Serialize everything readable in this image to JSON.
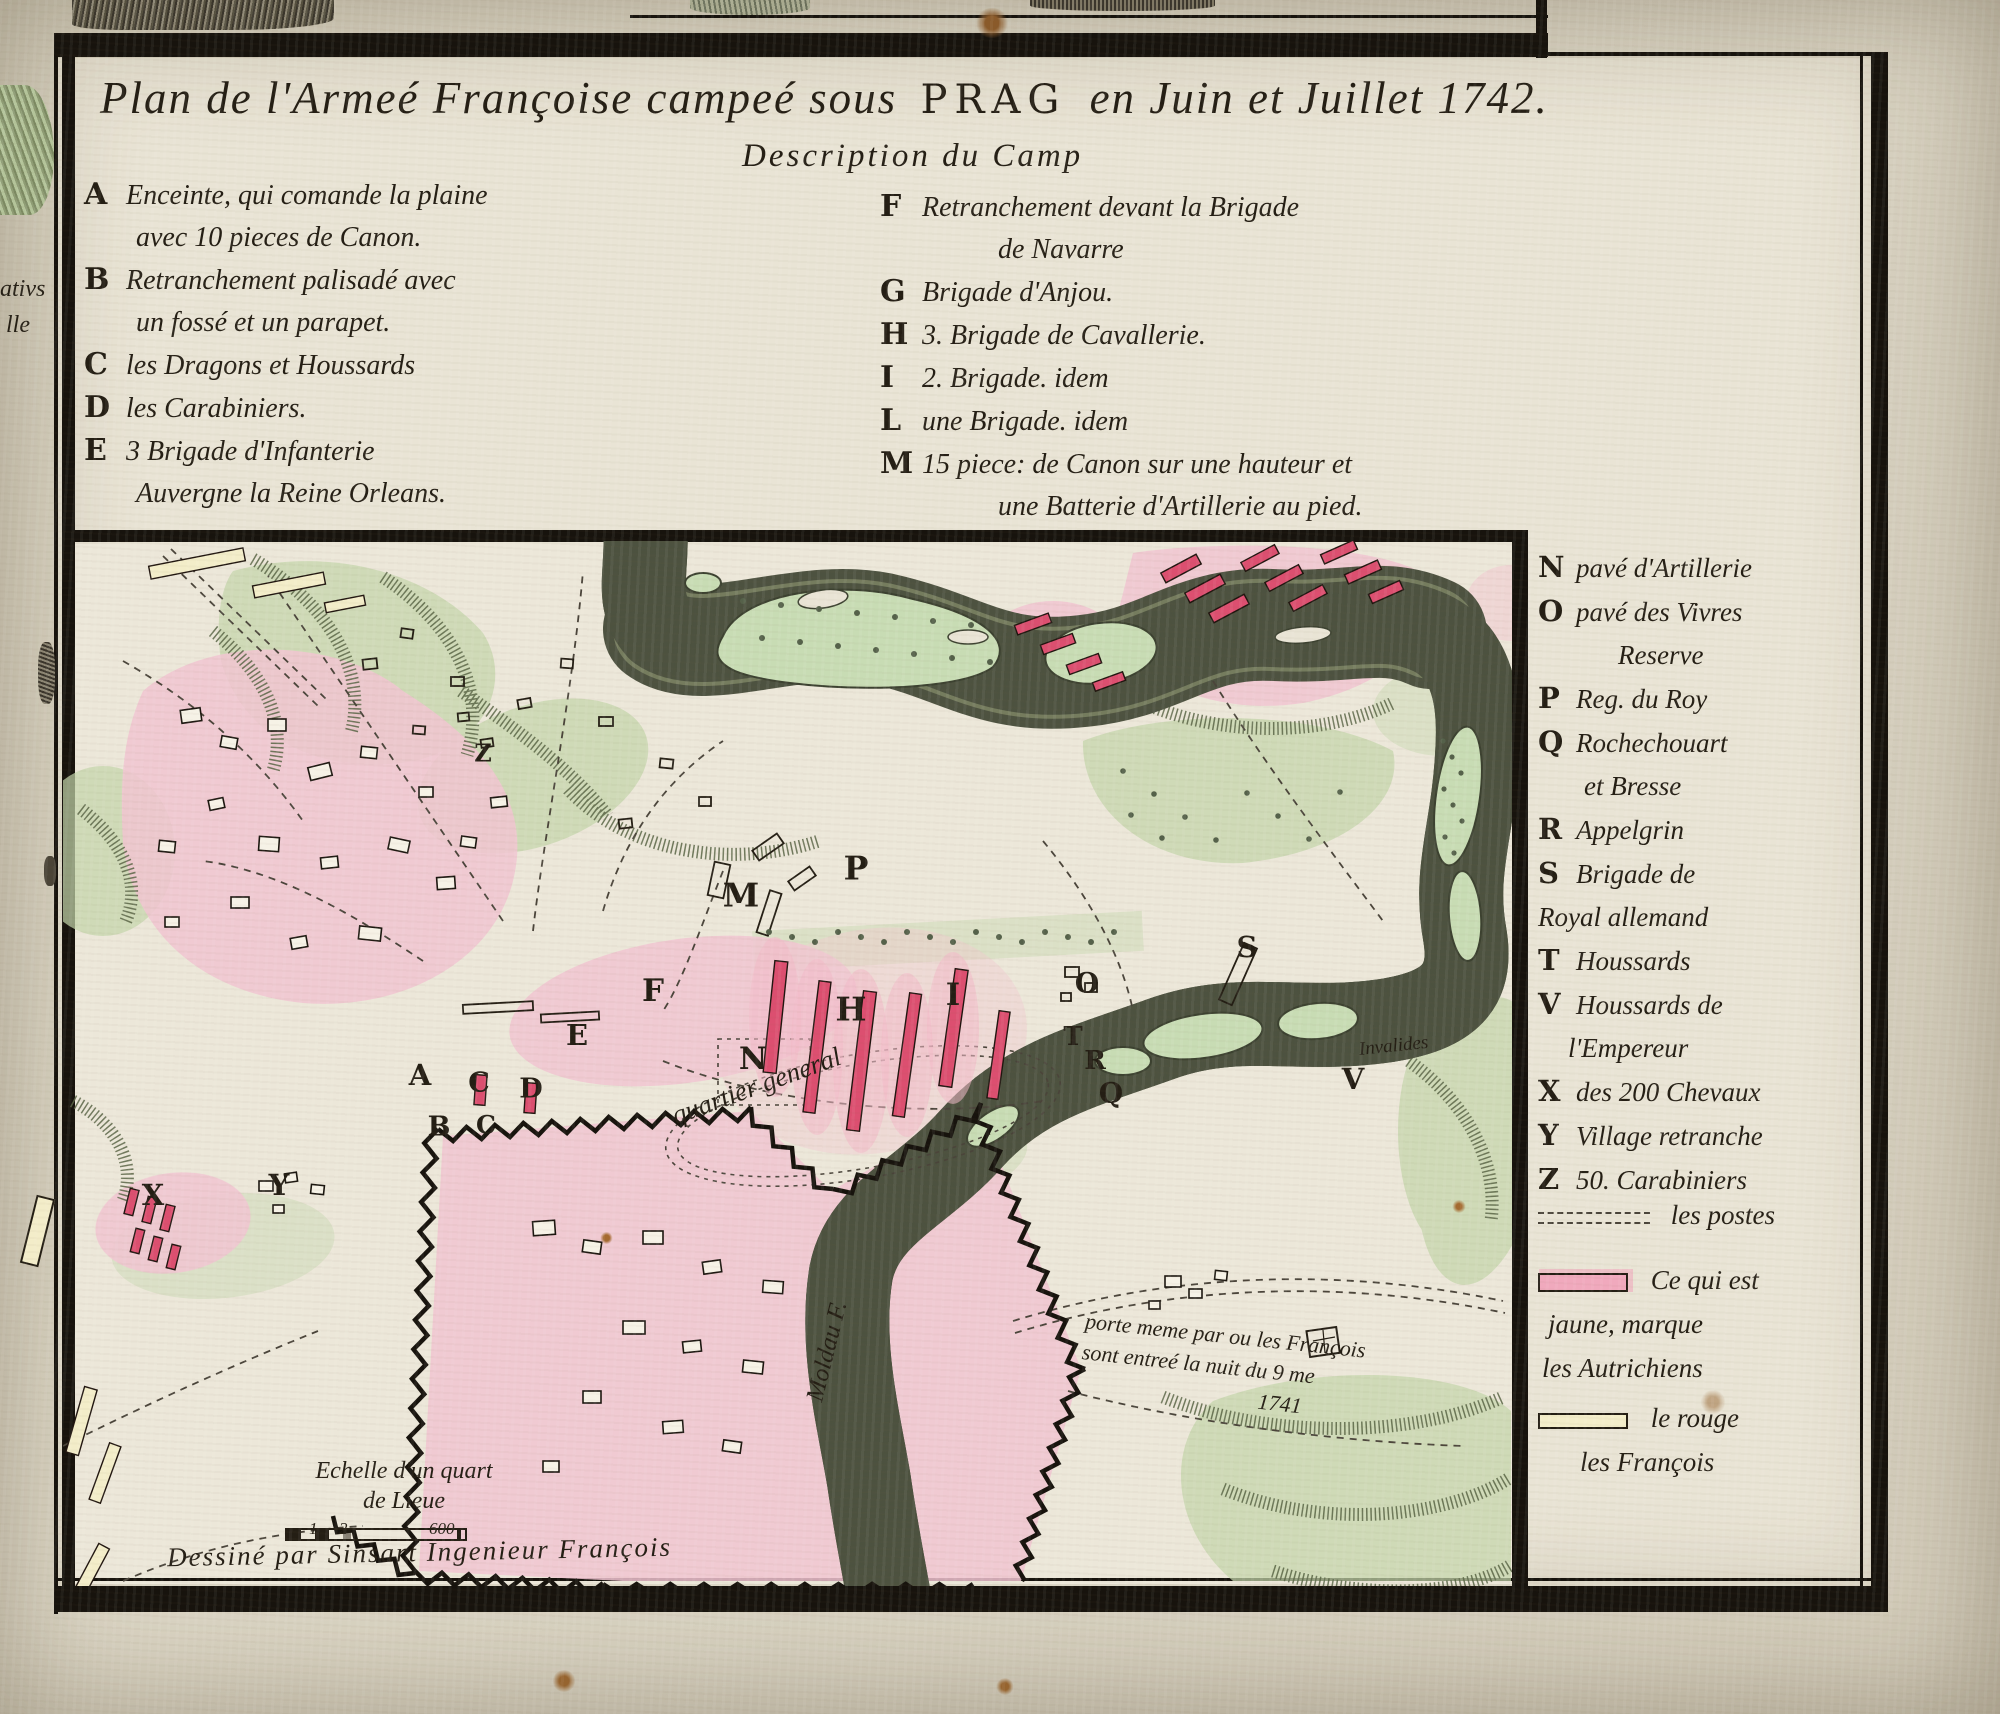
{
  "plate": {
    "title_prefix": "Plan de l'Armeé Françoise campeé sous",
    "title_place": "Prag",
    "title_suffix": "en Juin et Juillet 1742.",
    "subtitle": "Description du Camp",
    "legend_left": [
      {
        "key": "A",
        "lines": [
          "Enceinte, qui comande la plaine",
          "avec 10 pieces de Canon."
        ]
      },
      {
        "key": "B",
        "lines": [
          "Retranchement palisadé avec",
          "un fossé et un parapet."
        ]
      },
      {
        "key": "C",
        "lines": [
          "les Dragons et Houssards"
        ]
      },
      {
        "key": "D",
        "lines": [
          "les Carabiniers."
        ]
      },
      {
        "key": "E",
        "lines": [
          "3 Brigade d'Infanterie",
          "Auvergne la Reine Orleans."
        ]
      }
    ],
    "legend_right": [
      {
        "key": "F",
        "lines": [
          "Retranchement devant la Brigade",
          "de Navarre"
        ]
      },
      {
        "key": "G",
        "lines": [
          "Brigade d'Anjou."
        ]
      },
      {
        "key": "H",
        "lines": [
          "3. Brigade de Cavallerie."
        ]
      },
      {
        "key": "I",
        "lines": [
          "2. Brigade. idem"
        ]
      },
      {
        "key": "L",
        "lines": [
          "une Brigade. idem"
        ]
      },
      {
        "key": "M",
        "lines": [
          "15 piece: de Canon sur une hauteur et",
          "une Batterie d'Artillerie au pied."
        ]
      }
    ],
    "side_legend": [
      {
        "key": "N",
        "lines": [
          "pavé d'Artillerie"
        ]
      },
      {
        "key": "O",
        "lines": [
          "pavé des Vivres",
          "Reserve"
        ]
      },
      {
        "key": "P",
        "lines": [
          "Reg. du Roy"
        ]
      },
      {
        "key": "Q",
        "lines": [
          "Rochechouart",
          "et Bresse"
        ]
      },
      {
        "key": "R",
        "lines": [
          "Appelgrin"
        ]
      },
      {
        "key": "S",
        "lines": [
          "Brigade de",
          "Royal allemand"
        ]
      },
      {
        "key": "T",
        "lines": [
          "Houssards"
        ]
      },
      {
        "key": "V",
        "lines": [
          "Houssards de",
          "l'Empereur"
        ]
      },
      {
        "key": "X",
        "lines": [
          "des 200 Chevaux"
        ]
      },
      {
        "key": "Y",
        "lines": [
          "Village retranche"
        ]
      },
      {
        "key": "Z",
        "lines": [
          "50. Carabiniers"
        ]
      }
    ],
    "side_symbols": {
      "postes": "les postes",
      "austrians": [
        "Ce qui est",
        "jaune, marque",
        "les Autrichiens"
      ],
      "french": [
        "le rouge",
        "les François"
      ]
    },
    "map": {
      "markers": [
        {
          "label": "Z",
          "x": 420,
          "y": 212,
          "s": 24
        },
        {
          "label": "M",
          "x": 678,
          "y": 354,
          "s": 33
        },
        {
          "label": "P",
          "x": 793,
          "y": 327,
          "s": 33
        },
        {
          "label": "F",
          "x": 590,
          "y": 450,
          "s": 31
        },
        {
          "label": "E",
          "x": 514,
          "y": 494,
          "s": 29
        },
        {
          "label": "N",
          "x": 690,
          "y": 518,
          "s": 31
        },
        {
          "label": "H",
          "x": 788,
          "y": 468,
          "s": 33
        },
        {
          "label": "I",
          "x": 890,
          "y": 454,
          "s": 31
        },
        {
          "label": "O",
          "x": 1024,
          "y": 442,
          "s": 28
        },
        {
          "label": "S",
          "x": 1184,
          "y": 406,
          "s": 29
        },
        {
          "label": "A",
          "x": 357,
          "y": 534,
          "s": 29
        },
        {
          "label": "C",
          "x": 416,
          "y": 542,
          "s": 27
        },
        {
          "label": "D",
          "x": 468,
          "y": 548,
          "s": 27
        },
        {
          "label": "B",
          "x": 376,
          "y": 586,
          "s": 27
        },
        {
          "label": "C",
          "x": 423,
          "y": 584,
          "s": 25
        },
        {
          "label": "T",
          "x": 1010,
          "y": 496,
          "s": 26
        },
        {
          "label": "R",
          "x": 1032,
          "y": 520,
          "s": 26
        },
        {
          "label": "Q",
          "x": 1048,
          "y": 552,
          "s": 28
        },
        {
          "label": "V",
          "x": 1290,
          "y": 538,
          "s": 29
        },
        {
          "label": "X",
          "x": 90,
          "y": 654,
          "s": 29
        },
        {
          "label": "Y",
          "x": 216,
          "y": 644,
          "s": 29
        }
      ],
      "labels": [
        {
          "name": "quartier-general",
          "text": "quartier general",
          "x": 610,
          "y": 560,
          "rot": -20,
          "size": 27
        },
        {
          "name": "moldau-river",
          "text": "Moldau F.",
          "x": 752,
          "y": 846,
          "rot": -76,
          "size": 25
        },
        {
          "name": "invalides",
          "text": "Invalides",
          "x": 1296,
          "y": 498,
          "rot": -6,
          "size": 19
        }
      ],
      "note_lines": [
        "porte meme par ou les François",
        "sont  entreé  la nuit du 9 me",
        "1741"
      ],
      "scale_title_lines": [
        "Echelle d'un quart",
        "de Lieue"
      ],
      "scale_ticks": [
        "1",
        "2",
        "600"
      ],
      "credit": "Dessiné par Sinsart Ingenieur François"
    },
    "margin_fragments": {
      "top": "ativs",
      "bottom": "lle"
    }
  },
  "colors": {
    "paper": "#e9e4d5",
    "ink": "#241e14",
    "pink": "#f1c5d1",
    "red_bar": "#dc4f70",
    "green_light": "#c3d6ab",
    "green_dark": "#5a6546",
    "river_dark": "#4d5240",
    "river_mid": "#757c5e",
    "island": "#c8dcb4",
    "yellow": "#f3edc9"
  }
}
